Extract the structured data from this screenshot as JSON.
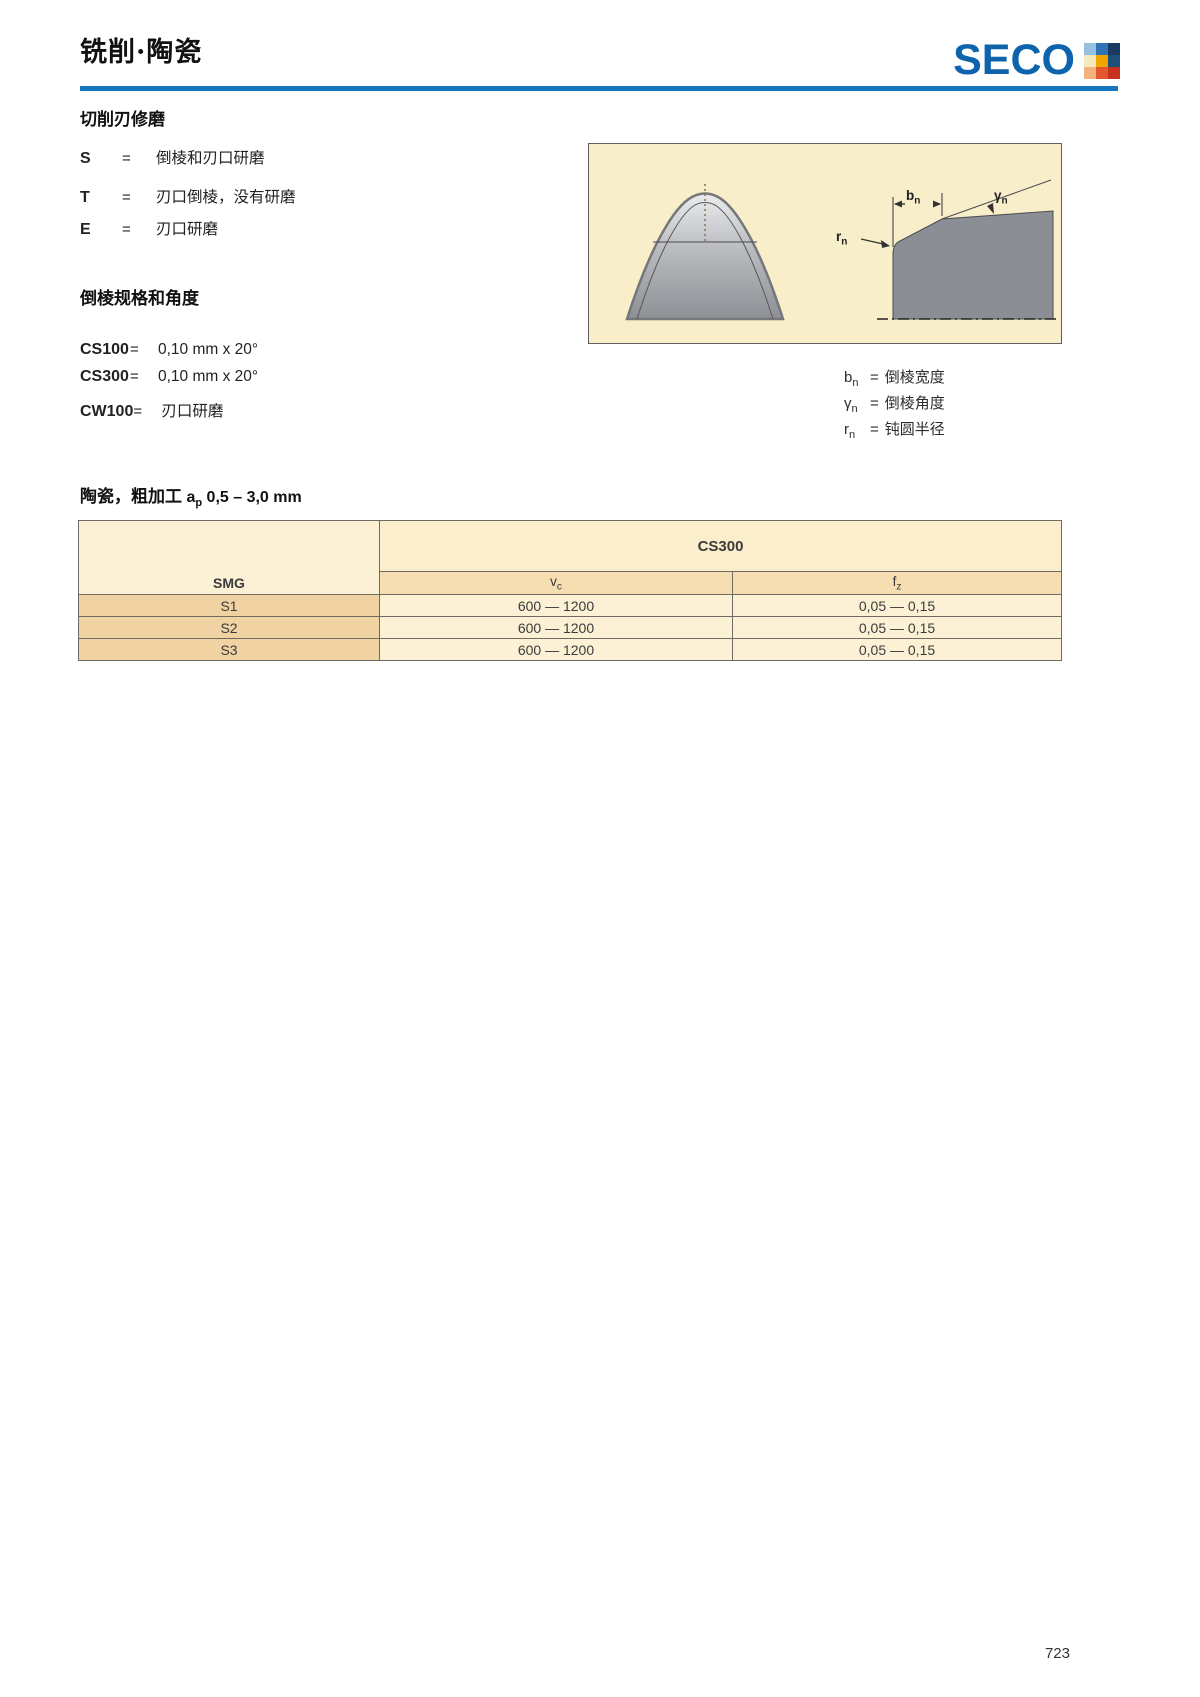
{
  "page": {
    "title": "铣削·陶瓷",
    "page_number": "723"
  },
  "logo": {
    "text": "SECO",
    "brand_blue": "#0d64ac",
    "rule_blue": "#1577be",
    "squares": [
      "#93c1de",
      "#2e74b5",
      "#1a3a5f",
      "#f5e9c0",
      "#f0a500",
      "#1f4e79",
      "#f2b27e",
      "#e4572e",
      "#c8311f"
    ]
  },
  "edge_section": {
    "heading": "切削刃修磨",
    "items": [
      {
        "code": "S",
        "eq": "=",
        "desc": "倒棱和刃口研磨"
      },
      {
        "code": "T",
        "eq": "=",
        "desc": "刃口倒棱，没有研磨"
      },
      {
        "code": "E",
        "eq": "=",
        "desc": "刃口研磨"
      }
    ]
  },
  "chamfer_section": {
    "heading": "倒棱规格和角度",
    "items": [
      {
        "code": "CS100",
        "eq": "=",
        "value": "0,10 mm x 20°"
      },
      {
        "code": "CS300",
        "eq": "=",
        "value": "0,10 mm x 20°"
      },
      {
        "code": "CW100",
        "eq": "=",
        "value": "刃口研磨"
      }
    ]
  },
  "diagram": {
    "bn": {
      "main": "b",
      "sub": "n"
    },
    "gamma": {
      "main": "γ",
      "sub": "n"
    },
    "rn": {
      "main": "r",
      "sub": "n"
    },
    "background": "#f8eeca",
    "legend": [
      {
        "sym": "b",
        "sub": "n",
        "eq": "=",
        "desc": "倒棱宽度"
      },
      {
        "sym": "γ",
        "sub": "n",
        "eq": "=",
        "desc": "倒棱角度"
      },
      {
        "sym": "r",
        "sub": "n",
        "eq": "=",
        "desc": "钝圆半径"
      }
    ]
  },
  "table": {
    "title_cn": "陶瓷，粗加工",
    "title_sym": "a",
    "title_sub": "p",
    "title_range": "0,5 – 3,0 mm",
    "group_header": "CS300",
    "col_smg": "SMG",
    "col_vc_main": "v",
    "col_vc_sub": "c",
    "col_fz_main": "f",
    "col_fz_sub": "z",
    "rows": [
      {
        "smg": "S1",
        "vc": "600 — 1200",
        "fz": "0,05 — 0,15"
      },
      {
        "smg": "S2",
        "vc": "600 — 1200",
        "fz": "0,05 — 0,15"
      },
      {
        "smg": "S3",
        "vc": "600 — 1200",
        "fz": "0,05 — 0,15"
      }
    ]
  }
}
